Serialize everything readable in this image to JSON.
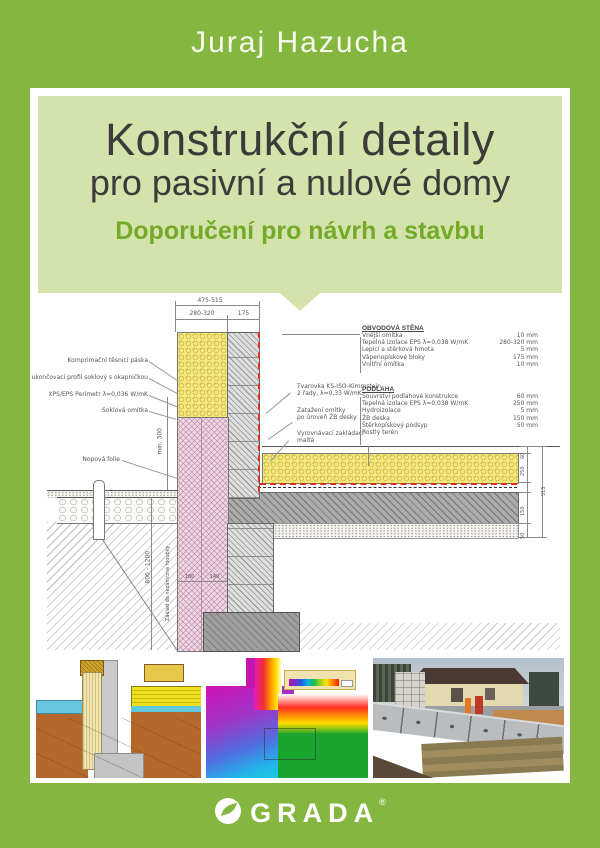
{
  "cover": {
    "author": "Juraj Hazucha",
    "title_line1": "Konstrukční detaily",
    "title_line2": "pro pasivní a nulové domy",
    "subtitle": "Doporučení pro návrh a stavbu",
    "publisher": "GRADA",
    "registered": "®"
  },
  "colors": {
    "cover_green": "#85b740",
    "panel_green": "#d4e3ab",
    "subtitle_green": "#74aa2a",
    "title_text": "#3b3b39",
    "insulation_yellow": "#f4e77c",
    "xps_pink": "#eed6e3",
    "airtight_red": "#d8301c"
  },
  "drawing": {
    "dims": {
      "top_total": "475-515",
      "top_left": "280-320",
      "top_right": "175",
      "left_min": "min. 300",
      "left_depth": "800 - 1200",
      "left_note": "Základ do nezámrzné hloubky",
      "bottom1": "180",
      "bottom2": "140",
      "right": [
        "60",
        "250",
        "150",
        "50"
      ],
      "right_total": "515"
    },
    "callouts_left": [
      {
        "text": "Komprimační těsnicí páska"
      },
      {
        "text": "ukončovací profil soklový s okapničkou"
      },
      {
        "text": "XPS/EPS Perimetr λ=0,036 W/mK"
      },
      {
        "text": "Soklová omítka"
      }
    ],
    "callout_nopova": "Nopová folie",
    "callouts_mid": [
      {
        "l1": "Tvarovka KS-ISO-Kimmstein",
        "l2": "2 řady, λ=0,33 W/mK"
      },
      {
        "l1": "Zatažení omítky",
        "l2": "po úroveň ŽB desky"
      },
      {
        "l1": "Vyrovnávací zakládací",
        "l2": "malta"
      }
    ],
    "legend": {
      "wall_title": "OBVODOVÁ STĚNA",
      "wall_items": [
        {
          "label": "Vnější omítka",
          "value": "10 mm"
        },
        {
          "label": "Tepelná izolace EPS λ=0,038 W/mK",
          "value": "280-320 mm"
        },
        {
          "label": "Lepící a stěrková hmota",
          "value": "5 mm"
        },
        {
          "label": "Vápenopískové bloky",
          "value": "175 mm"
        },
        {
          "label": "Vnitřní omítka",
          "value": "10 mm"
        }
      ],
      "floor_title": "PODLAHA",
      "floor_items": [
        {
          "label": "Souvrství podlahové konstrukce",
          "value": "60 mm"
        },
        {
          "label": "Tepelná izolace EPS λ=0,038 W/mK",
          "value": "250 mm"
        },
        {
          "label": "Hydroizolace",
          "value": "5 mm"
        },
        {
          "label": "ŽB deska",
          "value": "150 mm"
        },
        {
          "label": "Štěrkopískový podsyp",
          "value": "50 mm"
        }
      ],
      "floor_last": "Rostlý terén"
    }
  }
}
